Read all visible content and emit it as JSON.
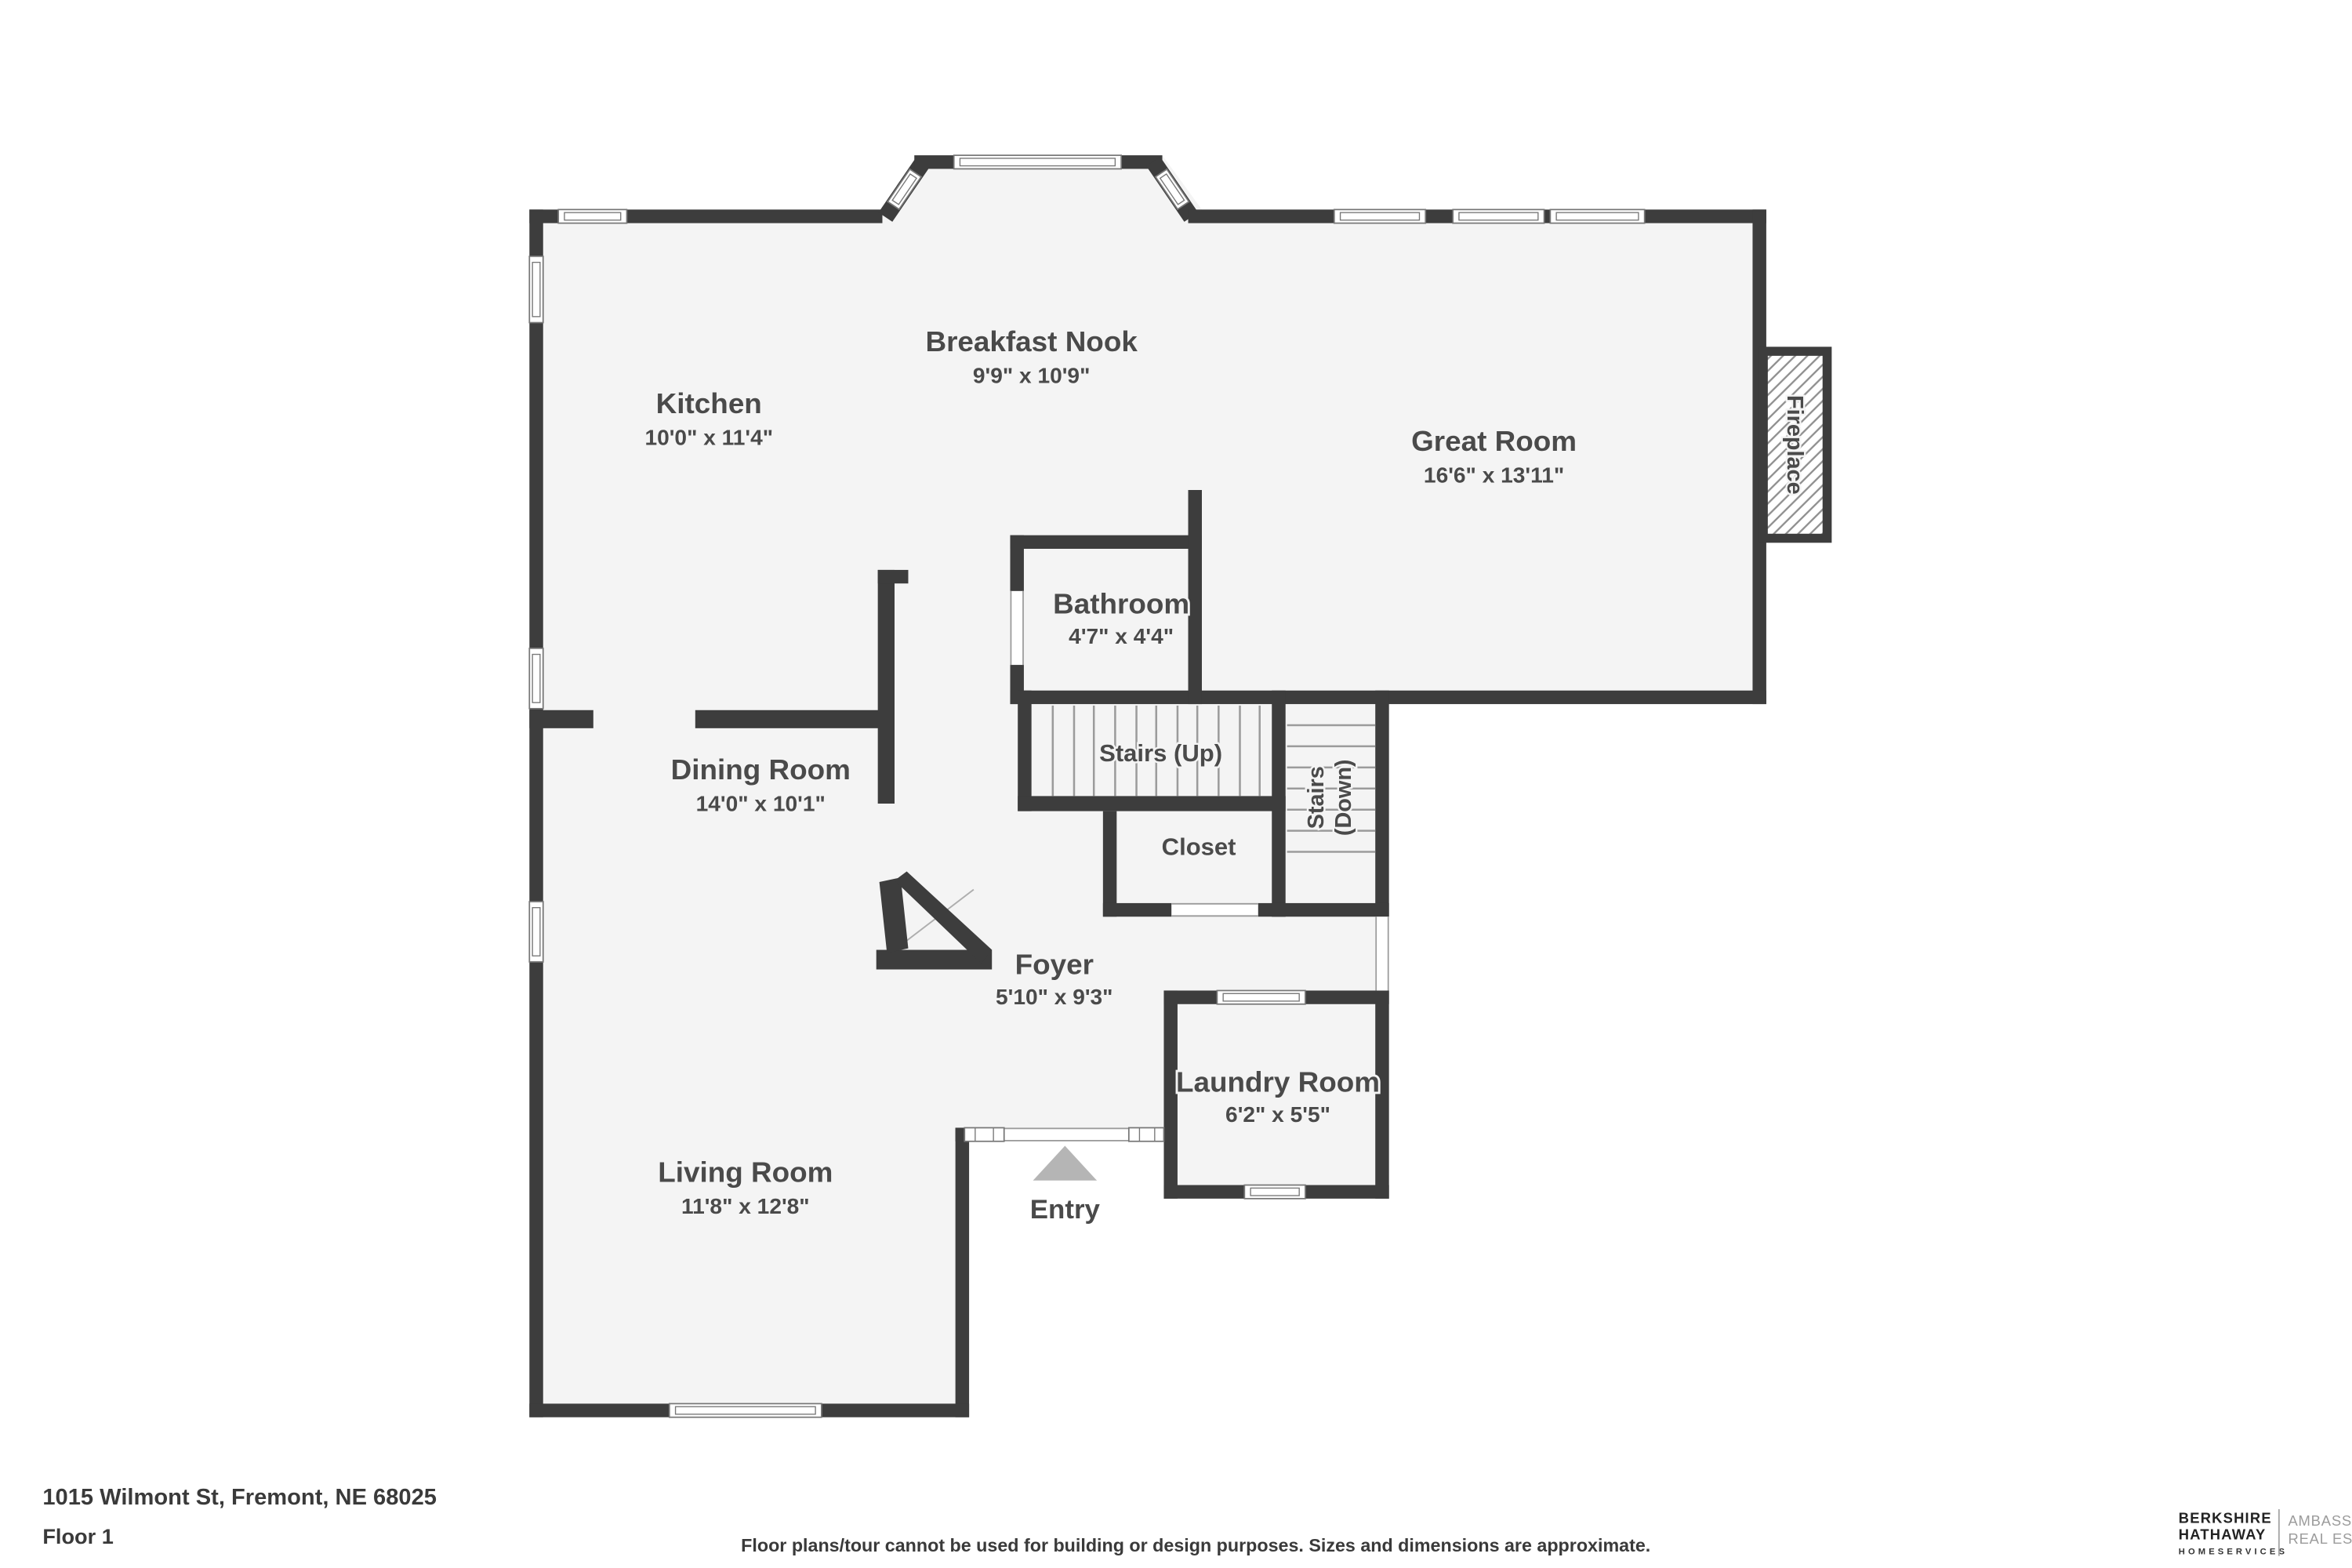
{
  "colors": {
    "wall": "#3d3d3d",
    "floor": "#f4f4f4",
    "label": "#4a4a4a",
    "entry_arrow": "#b5b5b5"
  },
  "plan": {
    "rooms": [
      {
        "name": "breakfast-nook",
        "label": "Breakfast Nook",
        "dims": "9'9\" x 10'9\""
      },
      {
        "name": "kitchen",
        "label": "Kitchen",
        "dims": "10'0\" x 11'4\""
      },
      {
        "name": "great-room",
        "label": "Great Room",
        "dims": "16'6\" x 13'11\""
      },
      {
        "name": "bathroom",
        "label": "Bathroom",
        "dims": "4'7\" x 4'4\""
      },
      {
        "name": "dining-room",
        "label": "Dining Room",
        "dims": "14'0\" x 10'1\""
      },
      {
        "name": "foyer",
        "label": "Foyer",
        "dims": "5'10\" x 9'3\""
      },
      {
        "name": "living-room",
        "label": "Living Room",
        "dims": "11'8\" x 12'8\""
      },
      {
        "name": "laundry-room",
        "label": "Laundry Room",
        "dims": "6'2\" x 5'5\""
      }
    ],
    "features": {
      "stairs_up": "Stairs (Up)",
      "stairs_down_line1": "Stairs",
      "stairs_down_line2": "(Down)",
      "closet": "Closet",
      "fireplace": "Fireplace",
      "entry": "Entry"
    }
  },
  "footer": {
    "address": "1015 Wilmont St, Fremont, NE 68025",
    "floor": "Floor 1",
    "disclaimer": "Floor plans/tour cannot be used for building or design purposes. Sizes and dimensions are approximate."
  },
  "branding": {
    "line1": "BERKSHIRE",
    "line2": "HATHAWAY",
    "line3": "HOMESERVICES",
    "right1": "AMBASSADOR",
    "right2": "REAL ESTATE"
  }
}
